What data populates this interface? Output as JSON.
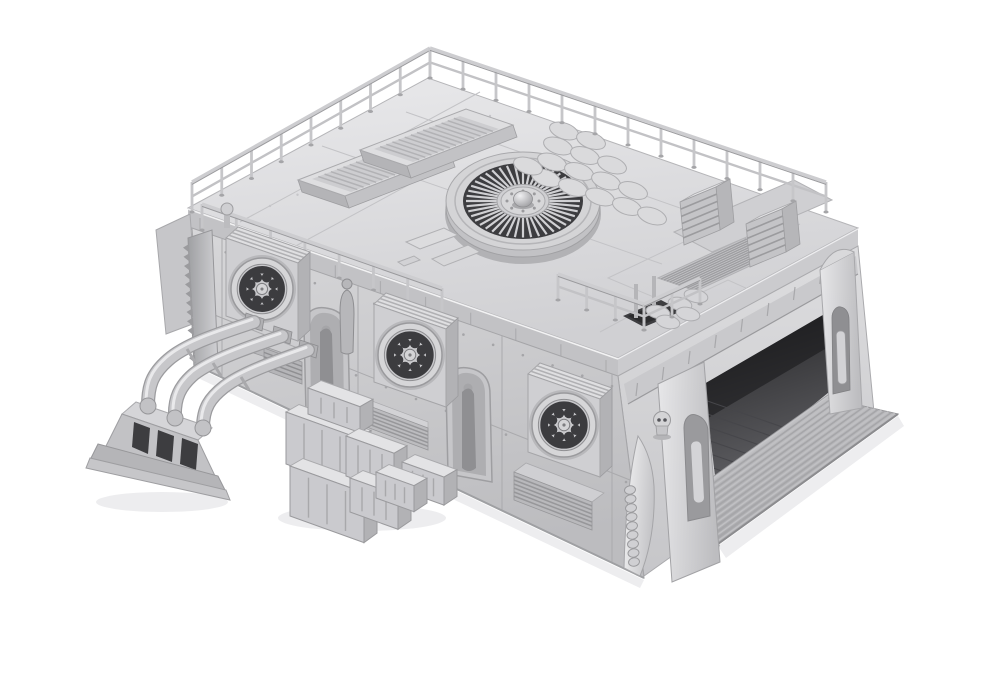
{
  "meta": {
    "title": "Grayscale 3D render of a modular sci-fi industrial hangar building on a plain white background",
    "view": "high three-quarter view from the front-left",
    "style": "monochrome clay render, no text or UI elements visible"
  },
  "palette": {
    "bg": "#ffffff",
    "surface_light": "#e8e8ea",
    "surface": "#d2d2d5",
    "surface_dim": "#c2c2c5",
    "surface_deep": "#aaaaad",
    "edge": "#9a9a9e",
    "dark_slot": "#3d3d40",
    "interior_dark": "#2a2a2c",
    "interior_floor": "#5c5c60",
    "shadow": "#ededef"
  },
  "scene": {
    "type": "3d_render",
    "background": "plain white, subtle contact shadows only",
    "objects": [
      {
        "id": "roof-turbine-fan",
        "label": "Roof turbine fan",
        "description": "large circular turbine with dark radial louver slots and domed hub"
      },
      {
        "id": "skylight-vents",
        "label": "Skylight vent boxes",
        "description": "two slatted louver skylight boxes on raised left roof platform"
      },
      {
        "id": "roof-railings",
        "label": "Roof railings",
        "description": "two-bar safety railings along rear roof edges and left platform"
      },
      {
        "id": "sandbag-wall",
        "label": "Sandbag barricade",
        "description": "stacked sandbag wall on the roof beside the turbine"
      },
      {
        "id": "roof-vent-boxes",
        "label": "Roof HVAC cubes",
        "description": "two louvered vent cubes on rear-right roof platform"
      },
      {
        "id": "roof-grate",
        "label": "Roof grate",
        "description": "flush louvered grate panel set into roof plating"
      },
      {
        "id": "access-platform",
        "label": "Roof access platform",
        "description": "railed corner platform with dark floor hatch and sandbags"
      },
      {
        "id": "fan-units",
        "label": "Wall fan housings",
        "description": "three protruding box housings with eight-hole circular fan grilles"
      },
      {
        "id": "arched-niches",
        "label": "Arched wall niches",
        "description": "two pointed-arch recesses holding robed statue figures"
      },
      {
        "id": "statue",
        "label": "Statue figure",
        "description": "small robed figure standing against the wall"
      },
      {
        "id": "skull-ornament",
        "label": "Skull ornament",
        "description": "small skull mounted at the front-right corner"
      },
      {
        "id": "blade-buttress",
        "label": "Blade buttress",
        "description": "fin-shaped corner buttress with ribbed spine detail"
      },
      {
        "id": "wall-vents",
        "label": "Base louver vents",
        "description": "louvered intake vents along the wall base"
      },
      {
        "id": "pipes",
        "label": "Pipe run",
        "description": "three curved pipes from the wall down into a ground manifold"
      },
      {
        "id": "pipe-manifold",
        "label": "Pipe manifold",
        "description": "stepped plinth block with three dark ports"
      },
      {
        "id": "supply-crates",
        "label": "Supply crates",
        "description": "stacked panelled cargo crates of assorted sizes"
      },
      {
        "id": "hangar-opening",
        "label": "Hangar bay opening",
        "description": "large open vehicle bay in right wall with dark tiled interior"
      },
      {
        "id": "hangar-ramp",
        "label": "Hangar ramp",
        "description": "wide ribbed access ramp descending from the bay"
      },
      {
        "id": "corner-pillars",
        "label": "Corner pillars",
        "description": "rounded armoured pillars with recessed lancet niches"
      },
      {
        "id": "left-fin",
        "label": "Serrated fin",
        "description": "toothed cooling fin on the left end wall"
      }
    ]
  }
}
